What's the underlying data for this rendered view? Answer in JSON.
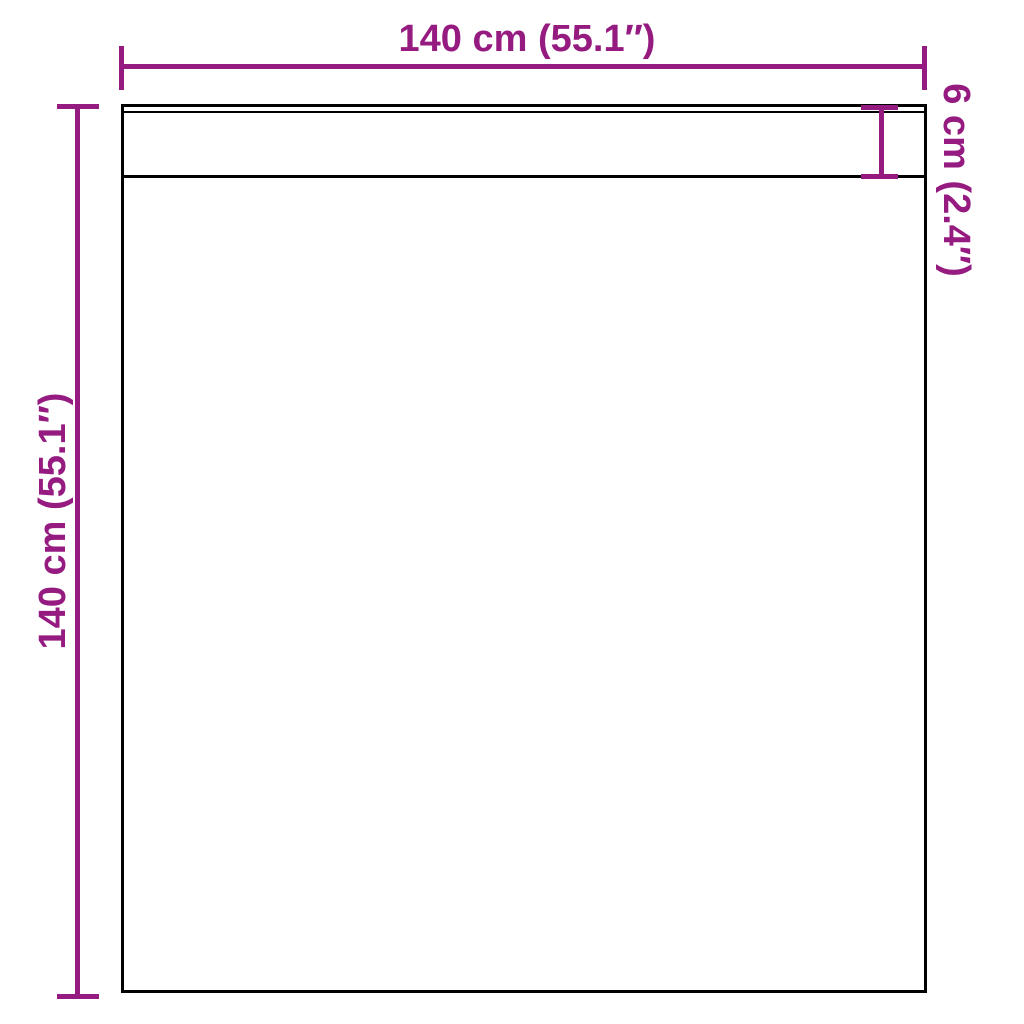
{
  "page": {
    "type": "product-dimension-diagram",
    "background": "#ffffff"
  },
  "colors": {
    "accent": "#951b81",
    "outline": "#000000"
  },
  "product": {
    "shape": "rectangular panel with top band",
    "band": "narrow hem band across full width at top"
  },
  "dimensions": {
    "width_label": "140 cm (55.1″)",
    "height_label": "140 cm (55.1″)",
    "band_label": "6 cm (2.4″)"
  }
}
